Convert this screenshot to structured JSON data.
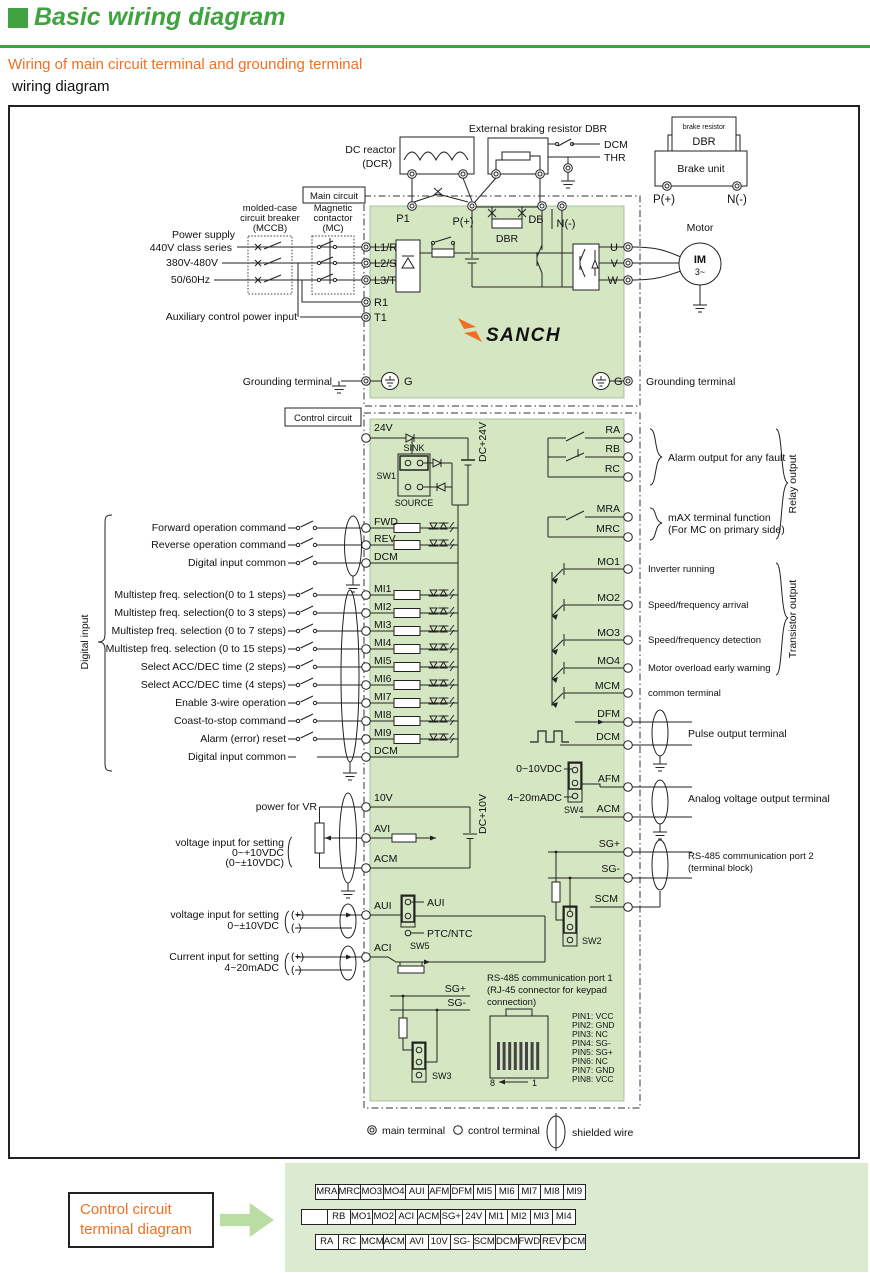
{
  "page": {
    "title": "Basic wiring diagram",
    "subtitle": "Wiring of main circuit terminal and grounding terminal",
    "subtitle2": "wiring diagram"
  },
  "colors": {
    "green": "#3fa33f",
    "orange": "#f26f21",
    "diagram_fill": "#d5e6c3",
    "panel_fill": "#dcead2",
    "arrow_green": "#b9dda3"
  },
  "top": {
    "dcr1": "DC reactor",
    "dcr2": "(DCR)",
    "ext": "External braking resistor DBR",
    "dcm": "DCM",
    "thr": "THR",
    "brake_res": "brake resistor",
    "dbr": "DBR",
    "brake_unit": "Brake unit",
    "p": "P(+)",
    "n": "N(-)"
  },
  "main": {
    "label": "Main circuit",
    "ps": "Power supply",
    "ps2": "440V class series",
    "ps3": "380V-480V",
    "ps4": "50/60Hz",
    "mccb1": "molded-case",
    "mccb2": "circuit breaker",
    "mccb3": "(MCCB)",
    "mc1": "Magnetic",
    "mc2": "contactor",
    "mc3": "(MC)",
    "aux": "Auxiliary control power input",
    "p1": "P1",
    "pp": "P(+)",
    "db": "DB",
    "nm": "N(-)",
    "dbr": "DBR",
    "l1": "L1/R",
    "l2": "L2/S",
    "l3": "L3/T",
    "r1": "R1",
    "t1": "T1",
    "u": "U",
    "v": "V",
    "w": "W",
    "g": "G",
    "gnd_l": "Grounding terminal",
    "gnd_r": "Grounding terminal",
    "motor": "Motor",
    "im": "IM",
    "ph": "3~",
    "logo": "SANCH"
  },
  "control": {
    "label": "Control circuit",
    "v24": "24V",
    "sink": "SINK",
    "sw1": "SW1",
    "source": "SOURCE",
    "dc24": "DC+24V",
    "dig": "Digital input",
    "din": [
      {
        "label": "Forward operation command",
        "t": "FWD"
      },
      {
        "label": "Reverse operation command",
        "t": "REV"
      },
      {
        "label": "Digital input common",
        "t": "DCM"
      },
      {
        "label": "Multistep freq. selection(0 to 1 steps)",
        "t": "MI1"
      },
      {
        "label": "Multistep freq. selection(0 to 3 steps)",
        "t": "MI2"
      },
      {
        "label": "Multistep freq. selection (0 to 7 steps)",
        "t": "MI3"
      },
      {
        "label": "Multistep freq. selection (0 to 15 steps)",
        "t": "MI4"
      },
      {
        "label": "Select ACC/DEC time (2 steps)",
        "t": "MI5"
      },
      {
        "label": "Select ACC/DEC time (4 steps)",
        "t": "MI6"
      },
      {
        "label": "Enable 3-wire operation",
        "t": "MI7"
      },
      {
        "label": "Coast-to-stop command",
        "t": "MI8"
      },
      {
        "label": "Alarm (error) reset",
        "t": "MI9"
      },
      {
        "label": "Digital input common",
        "t": "DCM"
      }
    ],
    "vr": "power for VR",
    "v10": "10V",
    "avi": "AVI",
    "acm": "ACM",
    "dc10": "DC+10V",
    "avi1": "voltage input for setting",
    "avi2": "0~+10VDC",
    "avi3": "(0~±10VDC)",
    "aui1": "voltage input for setting",
    "aui2": "0~±10VDC",
    "aci1": "Current input for setting",
    "aci2": "4~20mADC",
    "plus": "(+)",
    "minus": "(-)",
    "aui": "AUI",
    "sw5": "SW5",
    "sw5a": "AUI",
    "sw5b": "PTC/NTC",
    "aci": "ACI",
    "sgp": "SG+",
    "sgm": "SG-",
    "sw3": "SW3"
  },
  "out": {
    "relay": "Relay output",
    "ra": "RA",
    "rb": "RB",
    "rc": "RC",
    "alarm": "Alarm output for any fault",
    "mra": "MRA",
    "mrc": "MRC",
    "max1": "mAX terminal function",
    "max2": "(For MC on primary side)",
    "trans": "Transistor output",
    "mo": [
      {
        "t": "MO1",
        "label": "Inverter running"
      },
      {
        "t": "MO2",
        "label": "Speed/frequency arrival"
      },
      {
        "t": "MO3",
        "label": "Speed/frequency detection"
      },
      {
        "t": "MO4",
        "label": "Motor overload early warning"
      },
      {
        "t": "MCM",
        "label": "common terminal"
      }
    ],
    "dfm": "DFM",
    "dcm": "DCM",
    "pulse": "Pulse output terminal",
    "r1": "0~10VDC",
    "r2": "4~20mADC",
    "sw4": "SW4",
    "afm": "AFM",
    "acm": "ACM",
    "analog": "Analog voltage output terminal",
    "sgp": "SG+",
    "sgm": "SG-",
    "scm": "SCM",
    "sw2": "SW2",
    "p2a": "RS-485 communication port 2",
    "p2b": "(terminal block)",
    "p1a": "RS-485 communication port 1",
    "p1b": "(RJ-45 connector for keypad",
    "p1c": "connection)",
    "pins": [
      "PIN1: VCC",
      "PIN2: GND",
      "PIN3: NC",
      "PIN4: SG-",
      "PIN5: SG+",
      "PIN6: NC",
      "PIN7: GND",
      "PIN8: VCC"
    ],
    "n8": "8",
    "n1": "1"
  },
  "legend": {
    "main": "main terminal",
    "control": "control terminal",
    "shielded": "shielded wire"
  },
  "bottom": {
    "b1": "Control circuit",
    "b2": "terminal diagram",
    "row1": [
      "MRA",
      "MRC",
      "MO3",
      "MO4",
      "AUI",
      "AFM",
      "DFM",
      "MI5",
      "MI6",
      "MI7",
      "MI8",
      "MI9"
    ],
    "row2": [
      "RB",
      "MO1",
      "MO2",
      "ACI",
      "ACM",
      "SG+",
      "24V",
      "MI1",
      "MI2",
      "MI3",
      "MI4"
    ],
    "row3": [
      "RA",
      "RC",
      "MCM",
      "ACM",
      "AVI",
      "10V",
      "SG-",
      "SCM",
      "DCM",
      "FWD",
      "REV",
      "DCM"
    ]
  }
}
